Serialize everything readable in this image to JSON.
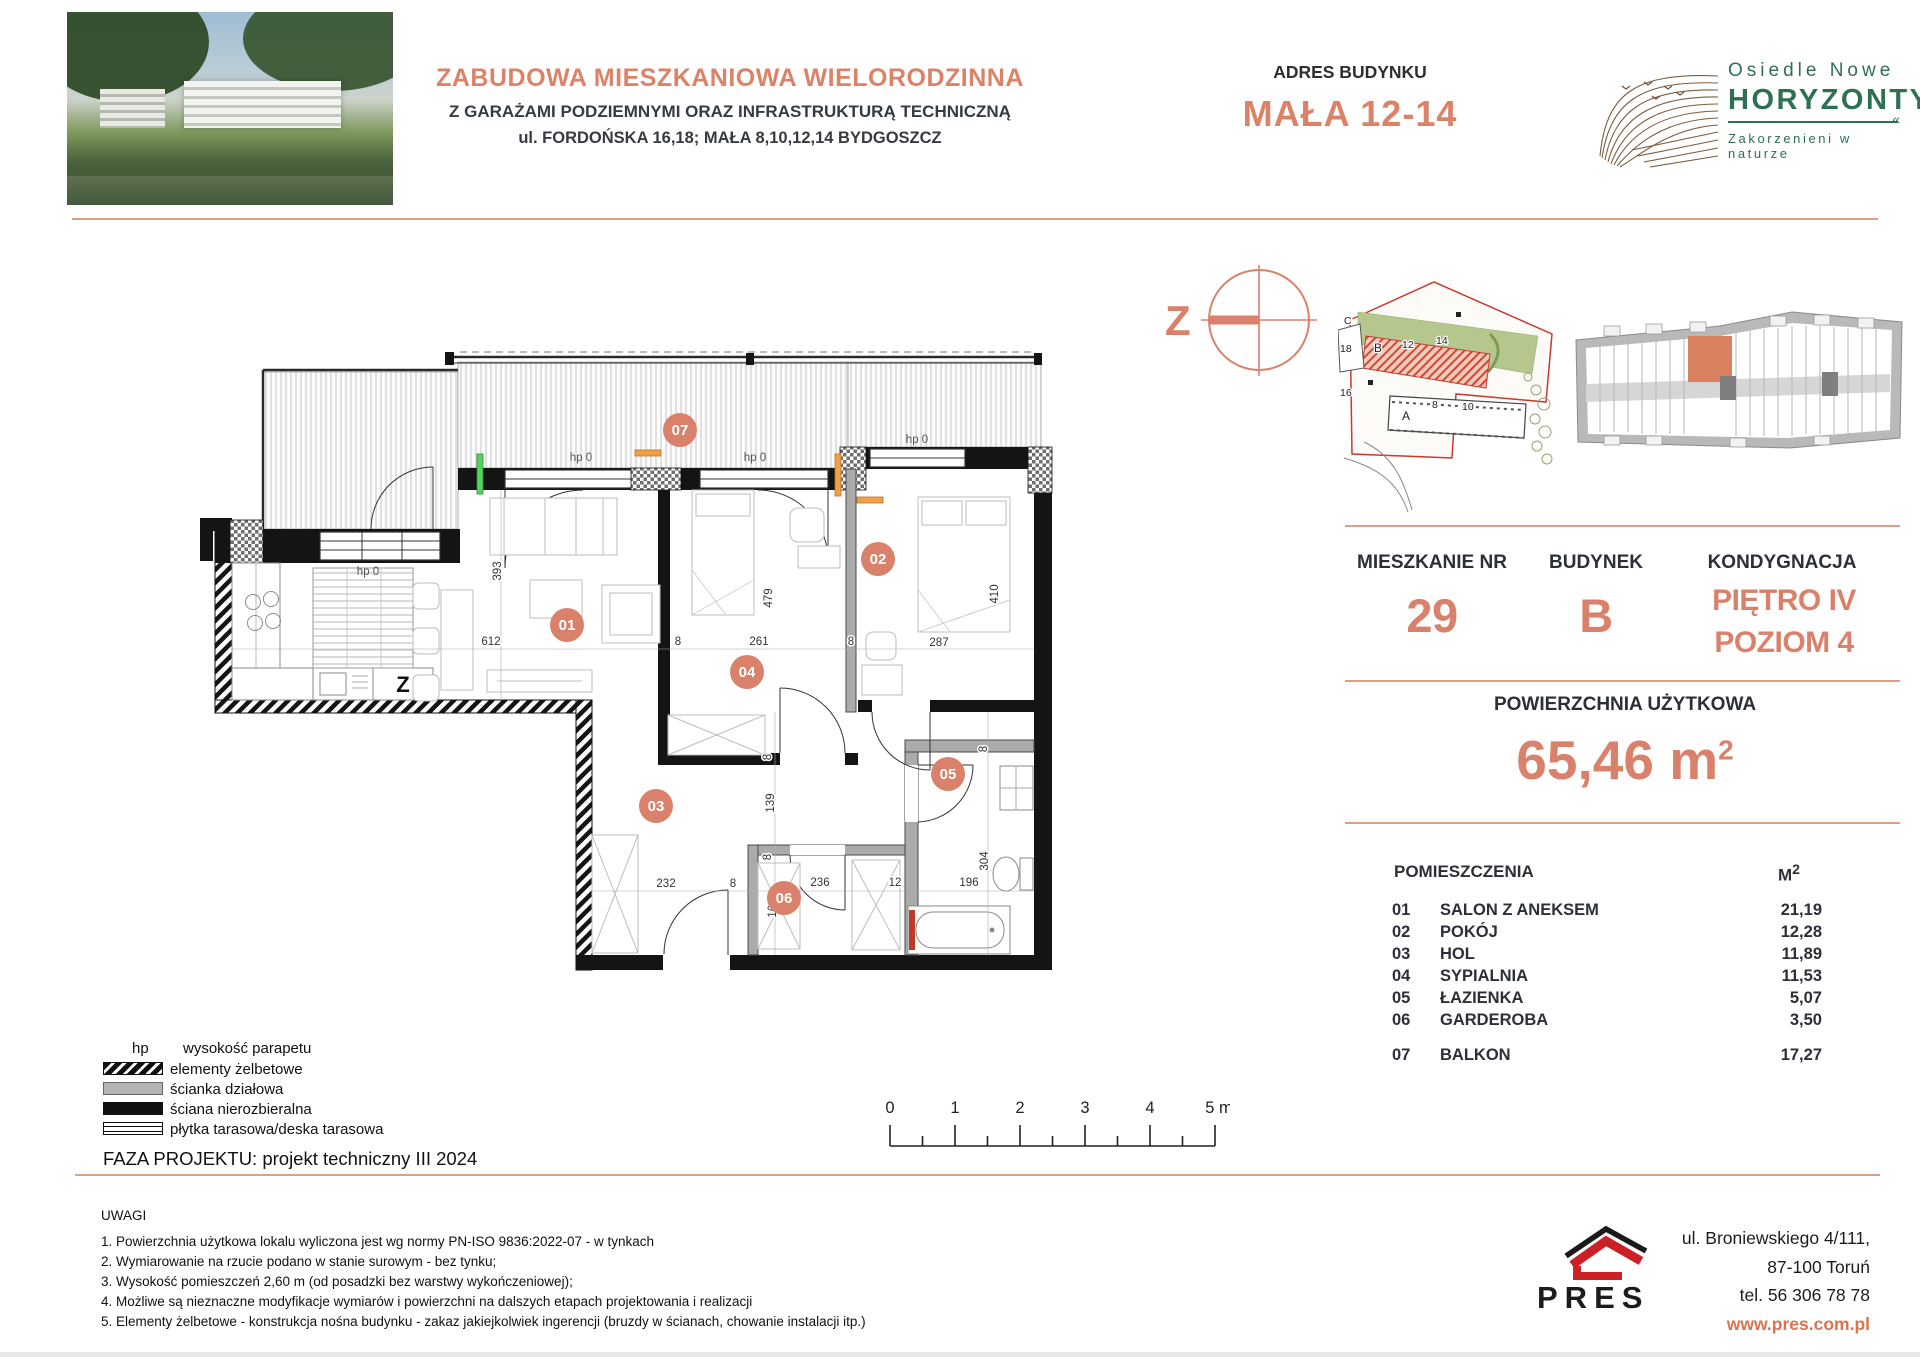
{
  "header": {
    "title_line1": "ZABUDOWA MIESZKANIOWA WIELORODZINNA",
    "title_line2": "Z GARAŻAMI PODZIEMNYMI ORAZ INFRASTRUKTURĄ TECHNICZNĄ",
    "title_line3": "ul. FORDOŃSKA 16,18; MAŁA 8,10,12,14 BYDGOSZCZ",
    "address_label": "ADRES BUDYNKU",
    "address_value": "MAŁA 12-14",
    "logo_line1": "Osiedle Nowe",
    "logo_line2": "HORYZONTY",
    "logo_tagline": "Zakorzenieni w naturze"
  },
  "compass": {
    "letter": "Z"
  },
  "site": {
    "labels": [
      "C",
      "18",
      "16",
      "B",
      "12",
      "14",
      "A",
      "8",
      "10"
    ]
  },
  "info": {
    "apartment_label": "MIESZKANIE NR",
    "apartment_value": "29",
    "building_label": "BUDYNEK",
    "building_value": "B",
    "floor_label": "KONDYGNACJA",
    "floor_value_line1": "PIĘTRO IV",
    "floor_value_line2": "POZIOM 4",
    "area_label": "POWIERZCHNIA UŻYTKOWA",
    "area_value": "65,46",
    "area_unit": "m",
    "area_sup": "2"
  },
  "rooms": {
    "header_name": "POMIESZCZENIA",
    "header_unit": "M",
    "header_unit_sup": "2",
    "items": [
      {
        "no": "01",
        "name": "SALON Z ANEKSEM",
        "area": "21,19"
      },
      {
        "no": "02",
        "name": "POKÓJ",
        "area": "12,28"
      },
      {
        "no": "03",
        "name": "HOL",
        "area": "11,89"
      },
      {
        "no": "04",
        "name": "SYPIALNIA",
        "area": "11,53"
      },
      {
        "no": "05",
        "name": "ŁAZIENKA",
        "area": "5,07"
      },
      {
        "no": "06",
        "name": "GARDEROBA",
        "area": "3,50"
      }
    ],
    "balcony": {
      "no": "07",
      "name": "BALKON",
      "area": "17,27"
    }
  },
  "plan": {
    "badges": [
      {
        "n": "01"
      },
      {
        "n": "02"
      },
      {
        "n": "03"
      },
      {
        "n": "04"
      },
      {
        "n": "05"
      },
      {
        "n": "06"
      },
      {
        "n": "07"
      }
    ],
    "dims": [
      {
        "t": "393"
      },
      {
        "t": "612"
      },
      {
        "t": "8"
      },
      {
        "t": "261"
      },
      {
        "t": "8"
      },
      {
        "t": "287"
      },
      {
        "t": "479"
      },
      {
        "t": "410"
      },
      {
        "t": "8"
      },
      {
        "t": "139"
      },
      {
        "t": "8"
      },
      {
        "t": "161"
      },
      {
        "t": "232"
      },
      {
        "t": "8"
      },
      {
        "t": "236"
      },
      {
        "t": "12"
      },
      {
        "t": "196"
      },
      {
        "t": "8"
      },
      {
        "t": "304"
      }
    ],
    "hp": [
      {
        "t": "hp 0"
      },
      {
        "t": "hp 0"
      },
      {
        "t": "hp 0"
      },
      {
        "t": "hp 0"
      }
    ],
    "kitchen_z": "Z"
  },
  "legend": {
    "hp_symbol": "hp",
    "hp_label": "wysokość parapetu",
    "items": [
      {
        "label": "elementy żelbetowe"
      },
      {
        "label": "ścianka działowa"
      },
      {
        "label": "ściana nierozbieralna"
      },
      {
        "label": "płytka tarasowa/deska tarasowa"
      }
    ],
    "phase": "FAZA PROJEKTU: projekt techniczny III 2024"
  },
  "scalebar": {
    "labels": [
      "0",
      "1",
      "2",
      "3",
      "4",
      "5 m"
    ]
  },
  "notes": {
    "title": "UWAGI",
    "items": [
      "1. Powierzchnia użytkowa lokalu wyliczona jest wg normy PN-ISO 9836:2022-07 - w tynkach",
      "2. Wymiarowanie na rzucie podano w stanie surowym - bez tynku;",
      "3. Wysokość pomieszczeń 2,60 m (od posadzki bez warstwy wykończeniowej);",
      "4. Możliwe są nieznaczne modyfikacje wymiarów i powierzchni na dalszych etapach projektowania i realizacji",
      "5. Elementy żelbetowe - konstrukcja nośna budynku - zakaz jakiejkolwiek ingerencji (bruzdy w ścianach, chowanie instalacji itp.)"
    ]
  },
  "footer": {
    "brand": "PRES",
    "address_line1": "ul. Broniewskiego  4/111,",
    "address_line2": "87-100 Toruń",
    "phone": "tel. 56 306 78 78",
    "website": "www.pres.com.pl"
  },
  "colors": {
    "accent": "#D9816A",
    "rule": "#DDA086",
    "logo_green": "#2F6F52",
    "pres_red": "#CC2027",
    "site_red": "#C9392C",
    "site_green": "#B5C78D",
    "highlight_unit": "#D9805E"
  }
}
